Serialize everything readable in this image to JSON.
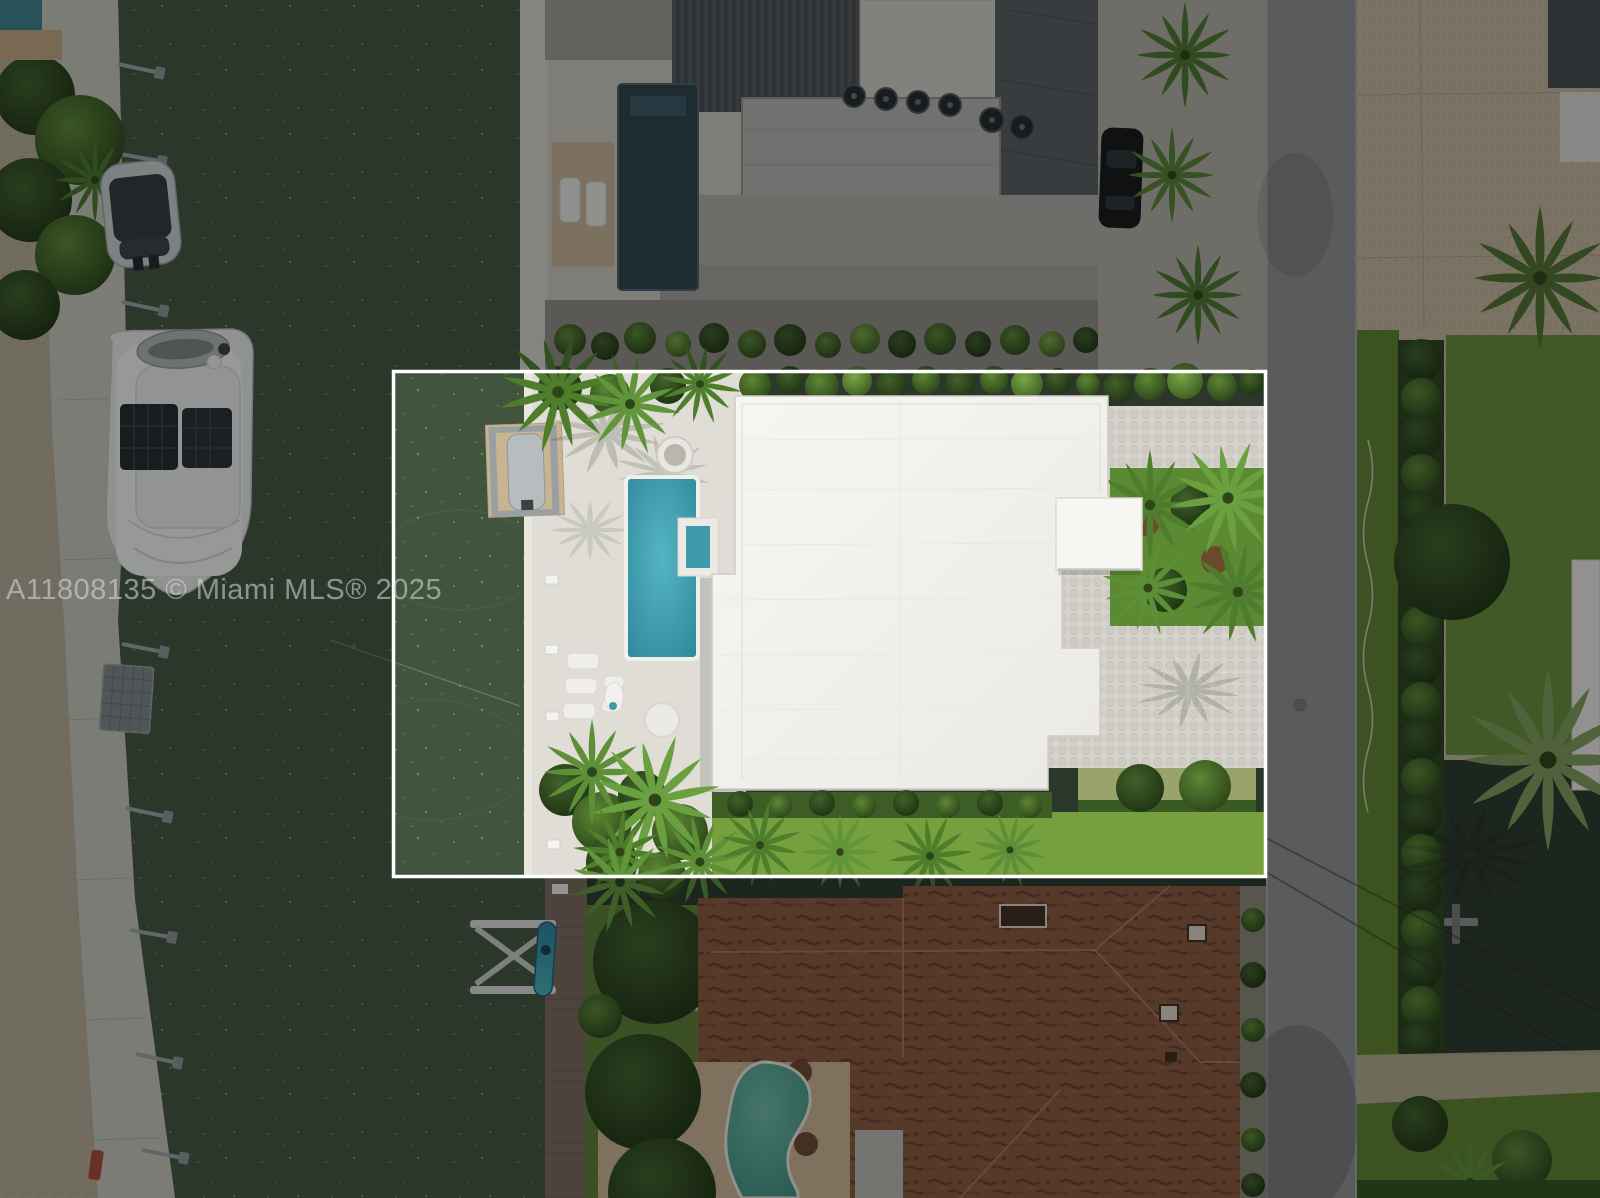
{
  "photo": {
    "type": "aerial-drone-photo-of-waterfront-property",
    "watermark": {
      "text": "A11808135 © Miami MLS® 2025",
      "color": "#dce0dc",
      "opacity": 0.55
    },
    "boundary": {
      "stroke": "#ffffff",
      "x": 393,
      "y": 371,
      "width": 873,
      "height": 506,
      "dim_opacity": 0.38
    },
    "colors": {
      "water": "#41543e",
      "deck_concrete": "#dfddd6",
      "white_roof": "#f4f3f0",
      "pool": "#3e9fae",
      "street": "#8f8f8f",
      "sand": "#b3a995",
      "paver_tan": "#c2b59c",
      "paver_light": "#d6d4cc",
      "lawn": "#75a03d",
      "terracotta_roof": "#8a573d",
      "dark_trees": "#2f4a1e",
      "palm_green": "#4e7d2c",
      "wood_dock": "#7b6a5c",
      "north_pool": "#2e434b",
      "south_pool": "#57a08e",
      "yacht_white": "#e6e7e5",
      "walkway_concrete": "#c6c3ba"
    },
    "scene_elements": [
      "canal-water",
      "left-seawall-walkway",
      "sandy-shore",
      "white-yacht",
      "covered-boat",
      "floating-dock",
      "dock-davits",
      "subject-pool-deck",
      "swimming-pool",
      "spa",
      "round-planter",
      "lounge-chairs",
      "white-flat-roof-house",
      "entry-canopy",
      "palm-garden",
      "paver-driveway",
      "lawn",
      "hedges",
      "street",
      "north-neighbor-house",
      "north-pool",
      "ac-units",
      "parked-car",
      "south-neighbor-terracotta-roof",
      "south-kidney-pool",
      "boat-lift",
      "kayak",
      "wood-dock",
      "stone-path",
      "round-trees",
      "power-lines",
      "property-boundary",
      "mls-watermark"
    ]
  }
}
